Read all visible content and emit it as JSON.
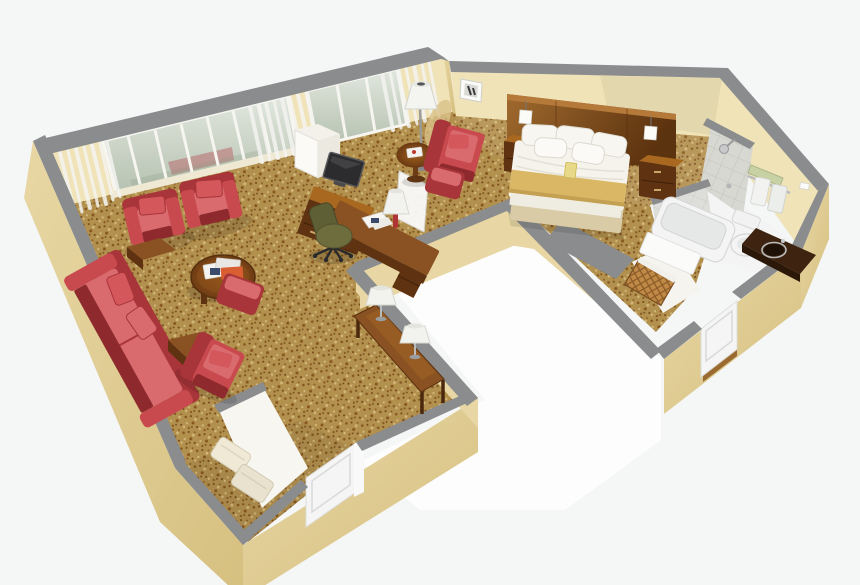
{
  "scene": {
    "kind": "isometric-3d-hotel-suite-floor-plan",
    "width_px": 860,
    "height_px": 585
  },
  "palette": {
    "background": "#f5f6f6",
    "exterior_floor": "#fdfdfd",
    "carpet_base": "#b2904e",
    "carpet_dot_dark": "#86561f",
    "carpet_dot_deep": "#74451a",
    "carpet_dot_light": "#d4b97c",
    "wall_top": "#8a8c8e",
    "wall_top_dark": "#747678",
    "wall_outer": "#e8d7a4",
    "wall_outer_dark": "#d6c080",
    "wall_inner": "#f0e3b8",
    "window_glass_top": "#e0e6dd",
    "window_glass_bottom": "#b6c2b1",
    "curtain": "#f4f4f1",
    "red_upholstery": "#c94a4e",
    "red_upholstery_dark": "#a83539",
    "red_upholstery_deep": "#8e2a2e",
    "red_upholstery_light": "#d96a6e",
    "wood_dark": "#5f3312",
    "wood_mid": "#8a5222",
    "wood_light": "#a8681f",
    "headboard_light": "#a06a2e",
    "headboard_dark": "#5c330f",
    "gold_throw": "#d9b765",
    "bedding": "#f5f3ec",
    "bed_skirt": "#d9cba6",
    "olive": "#6d6d3e",
    "tv": "#2c2c2e",
    "fixture": "#f3f4f3",
    "fixture_shade": "#d8d9d8",
    "vanity": "#3e2410",
    "towel_shelf_green": "#c8d1a4",
    "chrome": "#b9bcbd",
    "door": "#f4f5f4",
    "tile": "#d8d8d2",
    "tile_grout": "#c3c3bd",
    "woven": "#c08a46"
  },
  "rooms": {
    "living_room": {
      "furniture": [
        "red-armchair",
        "red-armchair",
        "red-sofa",
        "sofa-pillows",
        "wood-end-table",
        "wood-end-table",
        "round-coffee-table",
        "magazines",
        "red-lounge-chair",
        "red-ottoman",
        "console-table",
        "table-lamp",
        "table-lamp",
        "white-cabinet"
      ]
    },
    "work_area": {
      "furniture": [
        "tv-credenza",
        "flat-screen-tv",
        "work-desk",
        "desk-lamp",
        "papers",
        "office-chair",
        "privacy-screen"
      ]
    },
    "bedroom": {
      "furniture": [
        "wood-headboard",
        "reading-sconce",
        "reading-sconce",
        "double-bed",
        "pillows",
        "gold-throw-blanket",
        "nightstand",
        "nightstand",
        "red-armchair",
        "red-ottoman",
        "floor-lamp",
        "round-side-table",
        "wall-art",
        "luggage-bench",
        "bedroom-door"
      ]
    },
    "bathroom": {
      "fixtures": [
        "tiled-shower-wall",
        "shower-head",
        "bathtub",
        "toilet",
        "vanity-sink",
        "towel-rack",
        "towels",
        "wall-outlet"
      ]
    },
    "entry": {
      "items": [
        "entry-door",
        "closet-luggage-rack",
        "closet-luggage-rack"
      ]
    }
  }
}
